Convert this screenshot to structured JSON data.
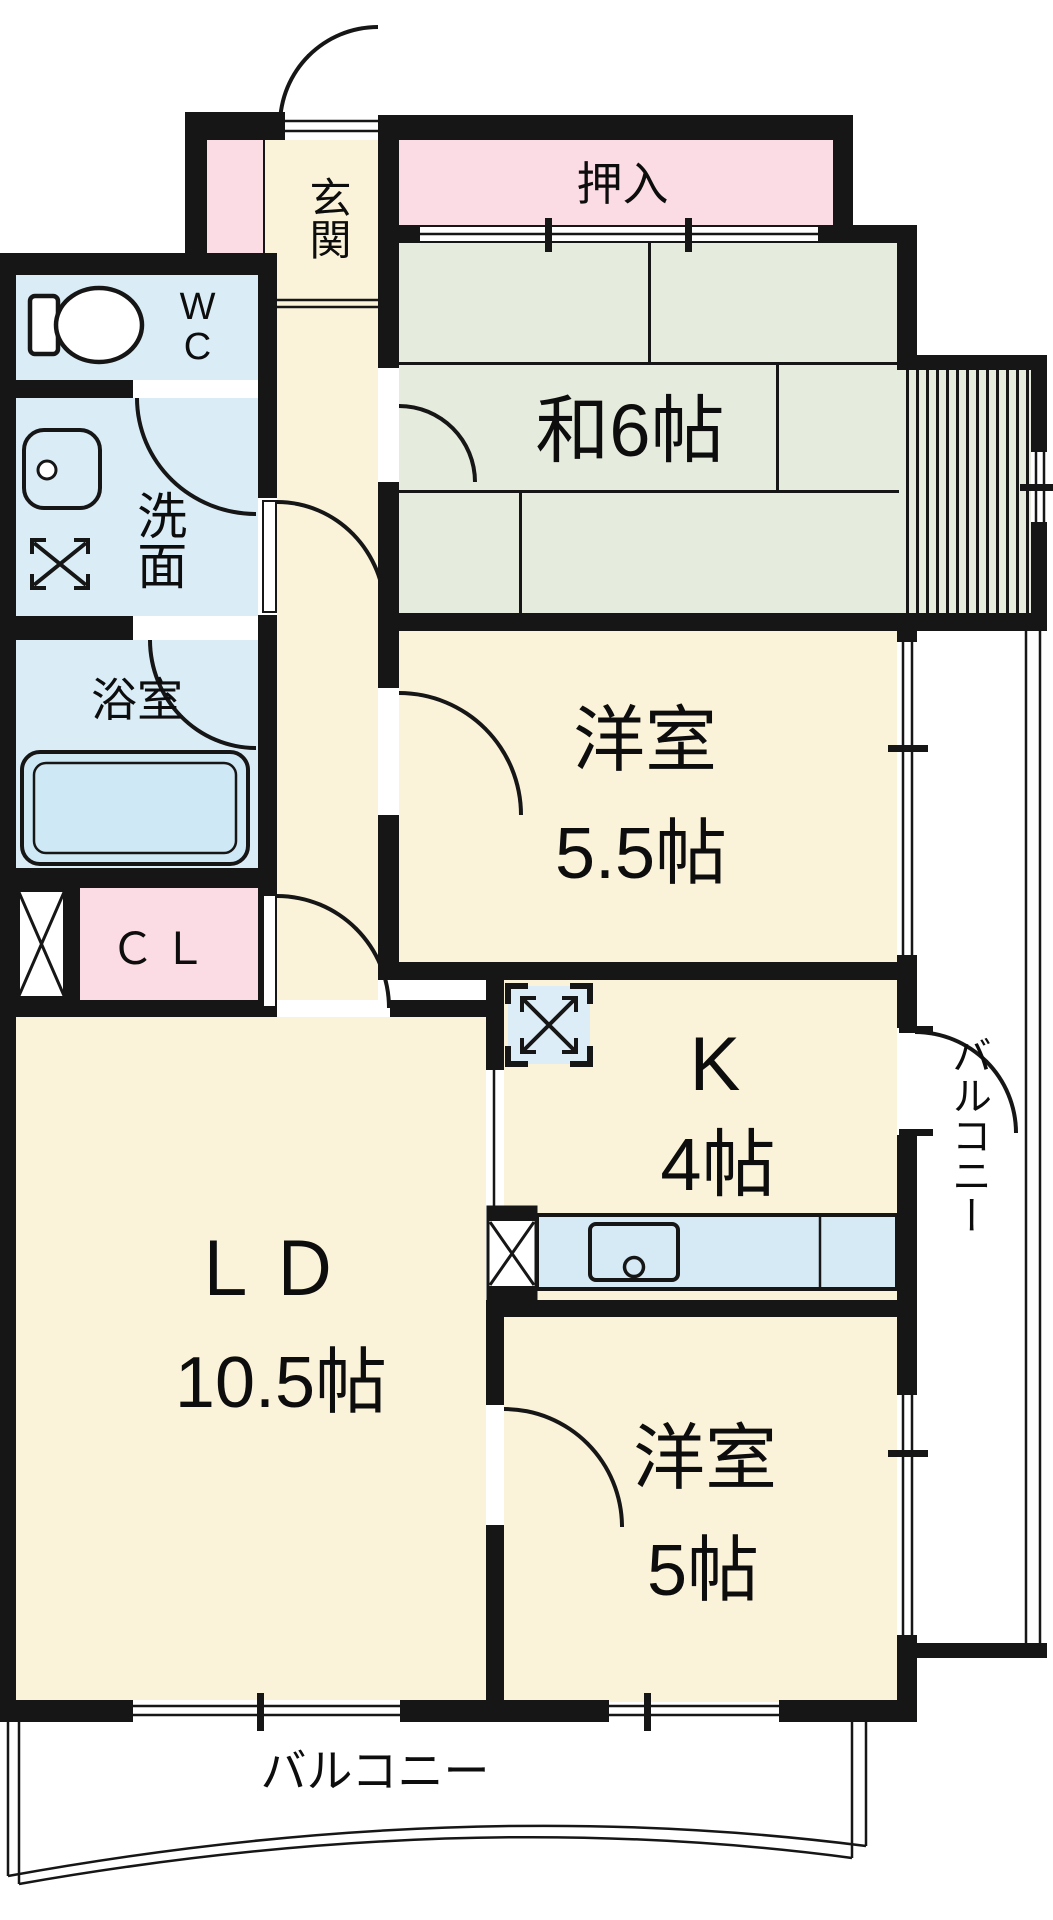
{
  "labels": {
    "genkan": "玄関",
    "oshiire": "押入",
    "washitsu": "和6帖",
    "wc_line1": "W",
    "wc_line2": "C",
    "senmen": "洗面",
    "yokushitsu": "浴室",
    "closet": "ＣＬ",
    "western55_name": "洋室",
    "western55_size": "5.5帖",
    "kitchen_name": "K",
    "kitchen_size": "4帖",
    "living_name": "ＬＤ",
    "living_size": "10.5帖",
    "western5_name": "洋室",
    "western5_size": "5帖",
    "balcony_right": "バルコニー",
    "balcony_bottom": "バルコニー"
  },
  "icons": {
    "toilet": "toilet-icon",
    "washbasin": "washbasin-icon",
    "washing_machine": "washing-machine-space-icon",
    "bathtub": "bathtub-icon",
    "refrigerator": "refrigerator-space-icon",
    "kitchen_sink": "kitchen-sink-icon",
    "pipe_space_left": "pipe-space-icon",
    "pipe_space_kitchen": "pipe-space-icon"
  },
  "colors": {
    "wall": "#161616",
    "room_cream": "#FAF3DA",
    "tatami_green": "#E5ECDE",
    "closet_pink": "#FBDCE4",
    "wet_area_blue": "#DAEDF7",
    "counter_blue": "#D6EAF6",
    "background": "#FFFFFF"
  }
}
